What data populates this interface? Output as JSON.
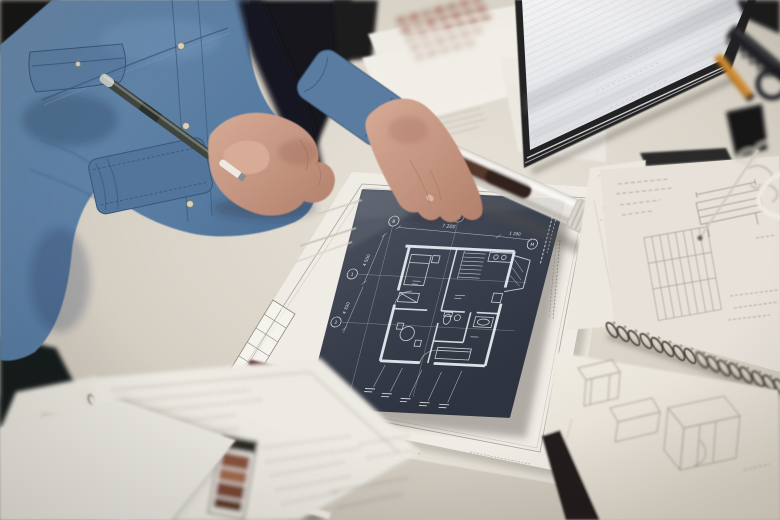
{
  "blueprint": {
    "dimensions": {
      "top": "7 200",
      "top_right": "1 200",
      "left_upper": "4 500",
      "left_lower": "4 320"
    },
    "grid_markers": {
      "top_left": "В",
      "top_mid": "Б",
      "right": "М",
      "left_upper": "1",
      "left_lower": "2"
    }
  },
  "colors": {
    "desk": "#d6cfc4",
    "floor": "#4e4a44",
    "background_dark": "#17171a",
    "denim": "#5d7fa3",
    "denim_shadow": "#3a5578",
    "skin": "#cb9b87",
    "paper": "#efece5",
    "blueprint_bg": "#3a404d",
    "blueprint_line": "#e7eaf0",
    "notebook_cover": "#212124",
    "pencil_orange": "#d29035",
    "binder_clip": "#161618",
    "brick_print": "#8a523c",
    "sketch_line": "#9b958b"
  }
}
